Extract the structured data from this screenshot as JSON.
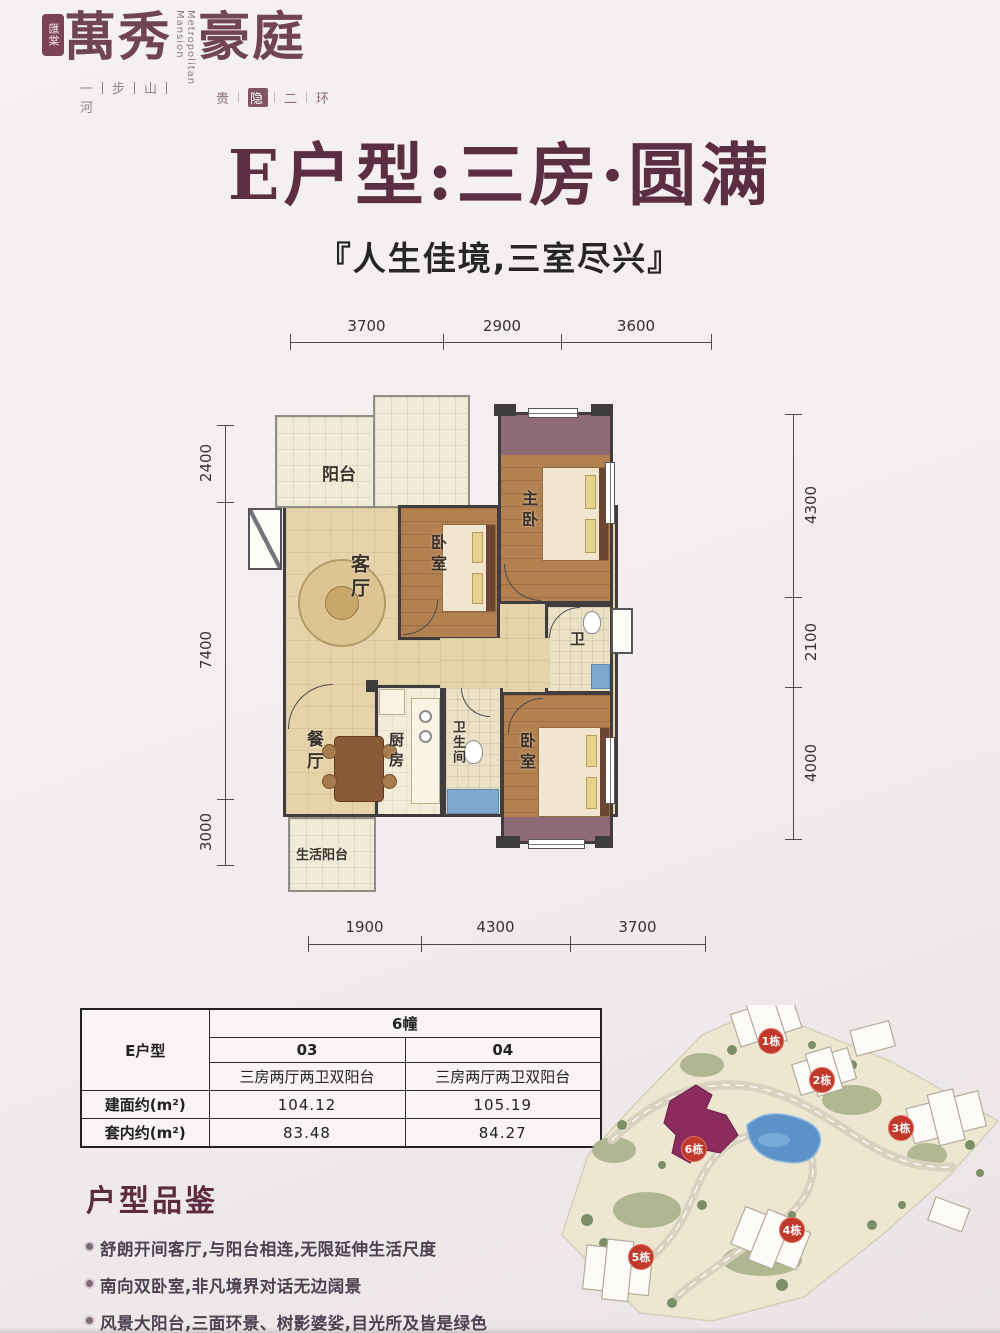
{
  "logo": {
    "seal": "匯棠",
    "name_left": "萬秀",
    "name_en_top": "Metropolitan",
    "name_en_bottom": "Mansion",
    "name_right": "豪庭",
    "tagline_left": "一丨步丨山丨河",
    "tagline_sep": "丨",
    "tagline_right_chars": [
      "贵",
      "隐",
      "二",
      "环"
    ]
  },
  "title": "E户型:三房·圆满",
  "subtitle": "『人生佳境,三室尽兴』",
  "floorplan": {
    "dims_top": [
      "3700",
      "2900",
      "3600"
    ],
    "dims_bottom": [
      "1900",
      "4300",
      "3700"
    ],
    "dims_left": [
      "2400",
      "7400",
      "3000"
    ],
    "dims_right": [
      "4300",
      "2100",
      "4000"
    ],
    "rooms": {
      "balcony": "阳台",
      "living": "客厅",
      "bedroom_a": "卧室",
      "master": "主卧",
      "bath_small": "卫",
      "dining": "餐厅",
      "kitchen": "厨房",
      "bathroom": "卫生间",
      "bedroom_b": "卧室",
      "life_balcony": "生活阳台"
    }
  },
  "table": {
    "unit": "E户型",
    "building": "6幢",
    "units": [
      "03",
      "04"
    ],
    "descs": [
      "三房两厅两卫双阳台",
      "三房两厅两卫双阳台"
    ],
    "row_area": {
      "label": "建面约(m²)",
      "v1": "104.12",
      "v2": "105.19"
    },
    "row_inner": {
      "label": "套内约(m²)",
      "v1": "83.48",
      "v2": "84.27"
    }
  },
  "review": {
    "heading": "户型品鉴",
    "bullets": [
      "舒朗开间客厅,与阳台相连,无限延伸生活尺度",
      "南向双卧室,非凡境界对话无边阔景",
      "风景大阳台,三面环景、树影婆娑,目光所及皆是绿色",
      "餐厅与客厅一线通达,室内储藏风景,每个角落都收纳阳光清风"
    ]
  },
  "sitemap": {
    "badges": [
      "1栋",
      "2栋",
      "3栋",
      "4栋",
      "5栋",
      "6栋"
    ]
  },
  "colors": {
    "accent_maroon": "#5e2b40",
    "badge_red": "#c0392b",
    "wall": "#413d3f",
    "building6_purple": "#8b2b5e"
  }
}
